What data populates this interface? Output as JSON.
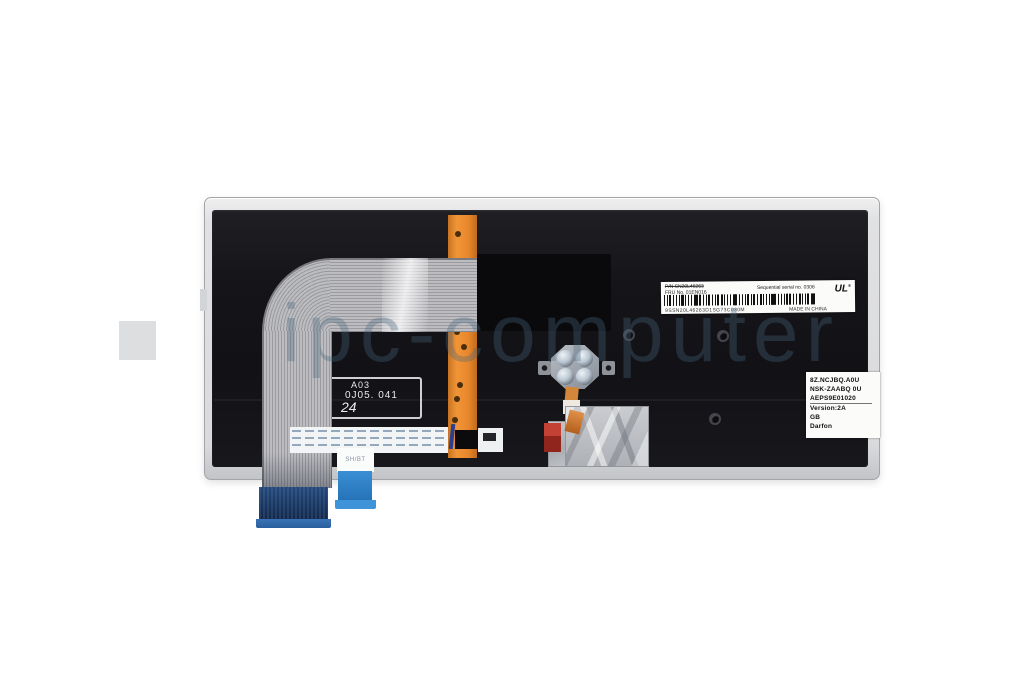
{
  "product_photo": {
    "description": "rear view of laptop replacement keyboard on white background",
    "watermark": {
      "text": "ipc-computer"
    },
    "barcode_label": {
      "pn": "P/N SN20L46263",
      "fru": "FRU No. 01EN016",
      "serial": "Sequential serial no. 0306",
      "code": "9SSN20L46263D1SG73C030M",
      "made_in": "MADE IN CHINA",
      "ul": "UL",
      "reg": "®"
    },
    "spec_label": {
      "lines": [
        "8Z.NCJBQ.A0U",
        "NSK-ZAABQ 0U",
        "AEPS9E01020",
        "Version:2A",
        "GB",
        "Darfon"
      ]
    },
    "etched_label": {
      "line1": "A03",
      "line2": "0J05. 041",
      "line3": "24"
    },
    "flex_tab": "SH/BT",
    "colors": {
      "panel": "#141418",
      "frame": "#dadbdd",
      "orange_strip": "#e8872c",
      "ribbon_cable": "#b5b5b9",
      "connector_large": "#173560",
      "connector_small": "#2f86cf",
      "foil": "#bfc2c6",
      "red_tab": "#b03028",
      "watermark": "#c7d0d6"
    }
  }
}
